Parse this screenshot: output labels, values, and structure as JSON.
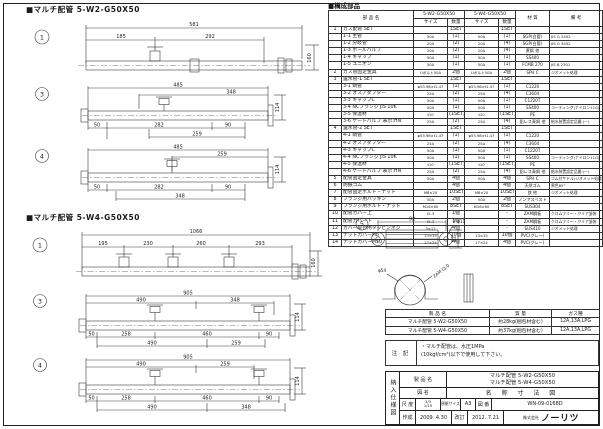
{
  "w2": {
    "title": "■マルチ配管 5-W2-G50X50",
    "v1": {
      "no": "1",
      "total": "581",
      "d1": "185",
      "d2": "292",
      "v": "160"
    },
    "v3": {
      "no": "3",
      "total": "485",
      "t1": "348",
      "v": "114",
      "b1": "50",
      "b2": "282",
      "b3": "90",
      "c1": "259"
    },
    "v4": {
      "no": "4",
      "total": "485",
      "t1": "259",
      "v": "114",
      "b1": "50",
      "b2": "282",
      "b3": "90",
      "c1": "348"
    }
  },
  "w4": {
    "title": "■マルチ配管 5-W4-G50X50",
    "v1": {
      "no": "1",
      "total": "1066",
      "d1": "195",
      "d2": "230",
      "d3": "260",
      "d4": "293",
      "v": "160"
    },
    "v3": {
      "no": "3",
      "total": "905",
      "t1": "490",
      "t2": "348",
      "v": "114",
      "b1": "50",
      "b2": "258",
      "b3": "460",
      "b4": "90",
      "c1": "490",
      "c2": "259"
    },
    "v4": {
      "no": "4",
      "total": "905",
      "t1": "490",
      "t2": "259",
      "v": "114",
      "b1": "50",
      "b2": "258",
      "b3": "460",
      "b4": "90",
      "c1": "490",
      "c2": "348"
    }
  },
  "detail": {
    "no": "5",
    "w": "92",
    "holes": "2-φ11",
    "h": "32",
    "dia": "φ54",
    "note": "ZAM t3.0"
  },
  "parts_table": {
    "section_title": "■構成部品",
    "h_name": "部 品 名",
    "h_w2": "5-W2-G50X50",
    "h_w4": "5-W4-G50X50",
    "h_size": "サイズ",
    "h_qty": "数量",
    "h_mat": "材 質",
    "h_rmk": "備 考",
    "rows": [
      {
        "no": "1",
        "name": "ガス配管 SET",
        "s2": "",
        "q2": "1SET",
        "s4": "",
        "q4": "1SET",
        "mat": "",
        "rmk": ""
      },
      {
        "no": "",
        "name": "1-1 主管",
        "s2": "50A",
        "q2": "(1)",
        "s4": "50A",
        "q4": "(1)",
        "mat": "SGP(白管)",
        "rmk": "JIS G 3452"
      },
      {
        "no": "",
        "name": "1-2 分岐管",
        "s2": "20A",
        "q2": "(2)",
        "s4": "20A",
        "q4": "(4)",
        "mat": "SGP(白管)",
        "rmk": "JIS G 3452"
      },
      {
        "no": "",
        "name": "1-3 ボールバルブ",
        "s2": "20A",
        "q2": "(2)",
        "s4": "20A",
        "q4": "(4)",
        "mat": "黄銅 他",
        "rmk": ""
      },
      {
        "no": "",
        "name": "1-4 キャップ",
        "s2": "50A",
        "q2": "(1)",
        "s4": "50A",
        "q4": "(1)",
        "mat": "SS400",
        "rmk": ""
      },
      {
        "no": "",
        "name": "1-5 ユニオン",
        "s2": "50A",
        "q2": "(1)",
        "s4": "50A",
        "q4": "(1)",
        "mat": "FCMB 270",
        "rmk": "JIS B 2301"
      },
      {
        "no": "2",
        "name": "ガス管固定金具",
        "s2": "Uボルト50A",
        "q2": "2個",
        "s4": "Uボルト50A",
        "q4": "2個",
        "mat": "SPH C",
        "rmk": "ジオメット処理"
      },
      {
        "no": "3",
        "name": "還水管-1 SET",
        "s2": "",
        "q2": "1SET",
        "s4": "",
        "q4": "1SET",
        "mat": "",
        "rmk": ""
      },
      {
        "no": "",
        "name": "3-1 銅管",
        "s2": "φ53.98×t1.47",
        "q2": "(1)",
        "s4": "φ53.98×t1.47",
        "q4": "(1)",
        "mat": "C1220",
        "rmk": ""
      },
      {
        "no": "",
        "name": "3-2 オスアダプター",
        "s2": "25A",
        "q2": "(2)",
        "s4": "25A",
        "q4": "(4)",
        "mat": "C3604",
        "rmk": ""
      },
      {
        "no": "",
        "name": "3-3 キャップC",
        "s2": "50A",
        "q2": "(1)",
        "s4": "50A",
        "q4": "(1)",
        "mat": "C1220T",
        "rmk": ""
      },
      {
        "no": "",
        "name": "3-4 NCフランジ JIS 10K",
        "s2": "50A",
        "q2": "(1)",
        "s4": "50A",
        "q4": "(1)",
        "mat": "SS400",
        "rmk": "コーティング(ナイロン11G)"
      },
      {
        "no": "",
        "name": "3-5 保温材",
        "s2": "t10",
        "q2": "(1SET)",
        "s4": "t10",
        "q4": "(1SET)",
        "mat": "PE",
        "rmk": ""
      },
      {
        "no": "",
        "name": "3-6 ゲートバルブ 表示:HN",
        "s2": "25A",
        "q2": "(2)",
        "s4": "25A",
        "q4": "(4)",
        "mat": "鉛レス青銅 他",
        "rmk": "給水装置認定品番:(一)"
      },
      {
        "no": "4",
        "name": "還水管-2 SET",
        "s2": "",
        "q2": "1SET",
        "s4": "",
        "q4": "1SET",
        "mat": "",
        "rmk": ""
      },
      {
        "no": "",
        "name": "4-1 銅管",
        "s2": "φ53.98×t1.47",
        "q2": "(1)",
        "s4": "φ53.98×t1.47",
        "q4": "(1)",
        "mat": "C1220",
        "rmk": ""
      },
      {
        "no": "",
        "name": "4-2 オスアダプター",
        "s2": "25A",
        "q2": "(2)",
        "s4": "25A",
        "q4": "(4)",
        "mat": "C3604",
        "rmk": ""
      },
      {
        "no": "",
        "name": "4-3 キャップC",
        "s2": "50A",
        "q2": "(1)",
        "s4": "50A",
        "q4": "(1)",
        "mat": "C1220T",
        "rmk": ""
      },
      {
        "no": "",
        "name": "4-4 NCフランジ JIS 10K",
        "s2": "50A",
        "q2": "(1)",
        "s4": "50A",
        "q4": "(1)",
        "mat": "SS400",
        "rmk": "コーティング(ナイロン11G)"
      },
      {
        "no": "",
        "name": "4-5 保温材",
        "s2": "t10",
        "q2": "(1SET)",
        "s4": "t10",
        "q4": "(1SET)",
        "mat": "PE",
        "rmk": ""
      },
      {
        "no": "",
        "name": "4-6 ゲートバルブ 表示:HN",
        "s2": "25A",
        "q2": "(2)",
        "s4": "25A",
        "q4": "(4)",
        "mat": "鉛レス青銅 他",
        "rmk": "給水装置認定品番:(一)"
      },
      {
        "no": "5",
        "name": "配管固定金具",
        "s2": "50A",
        "q2": "4個",
        "s4": "50A",
        "q4": "4個",
        "mat": "SPH C",
        "rmk": "ゴム付サドル(ジオメット処理)"
      },
      {
        "no": "6",
        "name": "防振ゴム",
        "s2": "",
        "q2": "4個",
        "s4": "",
        "q4": "4個",
        "mat": "天然ゴム",
        "rmk": "黒色65°"
      },
      {
        "no": "7",
        "name": "配管固定ボルト・ナット",
        "s2": "M8×20",
        "q2": "10SET",
        "s4": "M8×20",
        "q4": "10SET",
        "mat": "鉄 他",
        "rmk": "ジオメット処理"
      },
      {
        "no": "8",
        "name": "フランジ用パッキン",
        "s2": "50A",
        "q2": "2個",
        "s4": "50A",
        "q4": "2個",
        "mat": "ノンアスベスト",
        "rmk": ""
      },
      {
        "no": "9",
        "name": "フランジ用ボルト・ナット",
        "s2": "M16×60",
        "q2": "8SET",
        "s4": "M16×60",
        "q4": "8SET",
        "mat": "SUS304",
        "rmk": ""
      },
      {
        "no": "10",
        "name": "配管カバー上",
        "s2": "t2.3",
        "q2": "1個",
        "s4": "",
        "q4": "-",
        "mat": "ZAM鋼板",
        "rmk": "クロムフリー・クリア塗装"
      },
      {
        "no": "11",
        "name": "配管カバー下",
        "s2": "t2.3",
        "q2": "1個",
        "s4": "",
        "q4": "-",
        "mat": "ZAM鋼板",
        "rmk": "クロムフリー・クリア塗装"
      },
      {
        "no": "12",
        "name": "カバー取付用タッピンネジ",
        "s2": "5×12",
        "q2": "4個",
        "s4": "",
        "q4": "-",
        "mat": "SUS410",
        "rmk": "ジオメット処理"
      },
      {
        "no": "13",
        "name": "ナットカバーM8",
        "s2": "13×15",
        "q2": "10個",
        "s4": "13×15",
        "q4": "10個",
        "mat": "PVC(グレー)",
        "rmk": ""
      },
      {
        "no": "14",
        "name": "ナットカバーM10",
        "s2": "17×24",
        "q2": "4個",
        "s4": "17×24",
        "q4": "4個",
        "mat": "PVC(グレー)",
        "rmk": ""
      }
    ]
  },
  "product_table": {
    "h_name": "製  品  名",
    "h_mass": "質  量",
    "h_gas": "ガス種",
    "rows": [
      {
        "name": "マルチ配管 5-W2-G50X50",
        "mass": "約28kg(梱包材含む)",
        "gas": "12A,13A,LPG"
      },
      {
        "name": "マルチ配管 5-W4-G50X50",
        "mass": "約37kg(梱包材含む)",
        "gas": "12A,13A,LPG"
      }
    ]
  },
  "notes": {
    "label": "注 記",
    "line1": "・マルチ配管は、水圧1MPa",
    "line2": "(10kgf/cm²)以下で使用して下さい。"
  },
  "title_block": {
    "side": "納入仕様図",
    "product_label": "製 品 名",
    "product1": "マルチ配管 5-W2-G50X50",
    "product2": "マルチ配管 5-W4-G50X50",
    "name_label": "図  名",
    "name": "名 称 寸 法 図",
    "scale_label": "尺 度",
    "scale1": "1/3",
    "scale2": "1/15",
    "paper_label": "原紙サイズ",
    "paper": "A3",
    "no_label": "図 番",
    "no": "WN-09-0168D",
    "made_label": "作成",
    "made": "2009. 4.30",
    "rev_label": "改訂",
    "rev": "2012. 7.21",
    "company_prefix": "株式会社",
    "company": "ノーリツ"
  }
}
